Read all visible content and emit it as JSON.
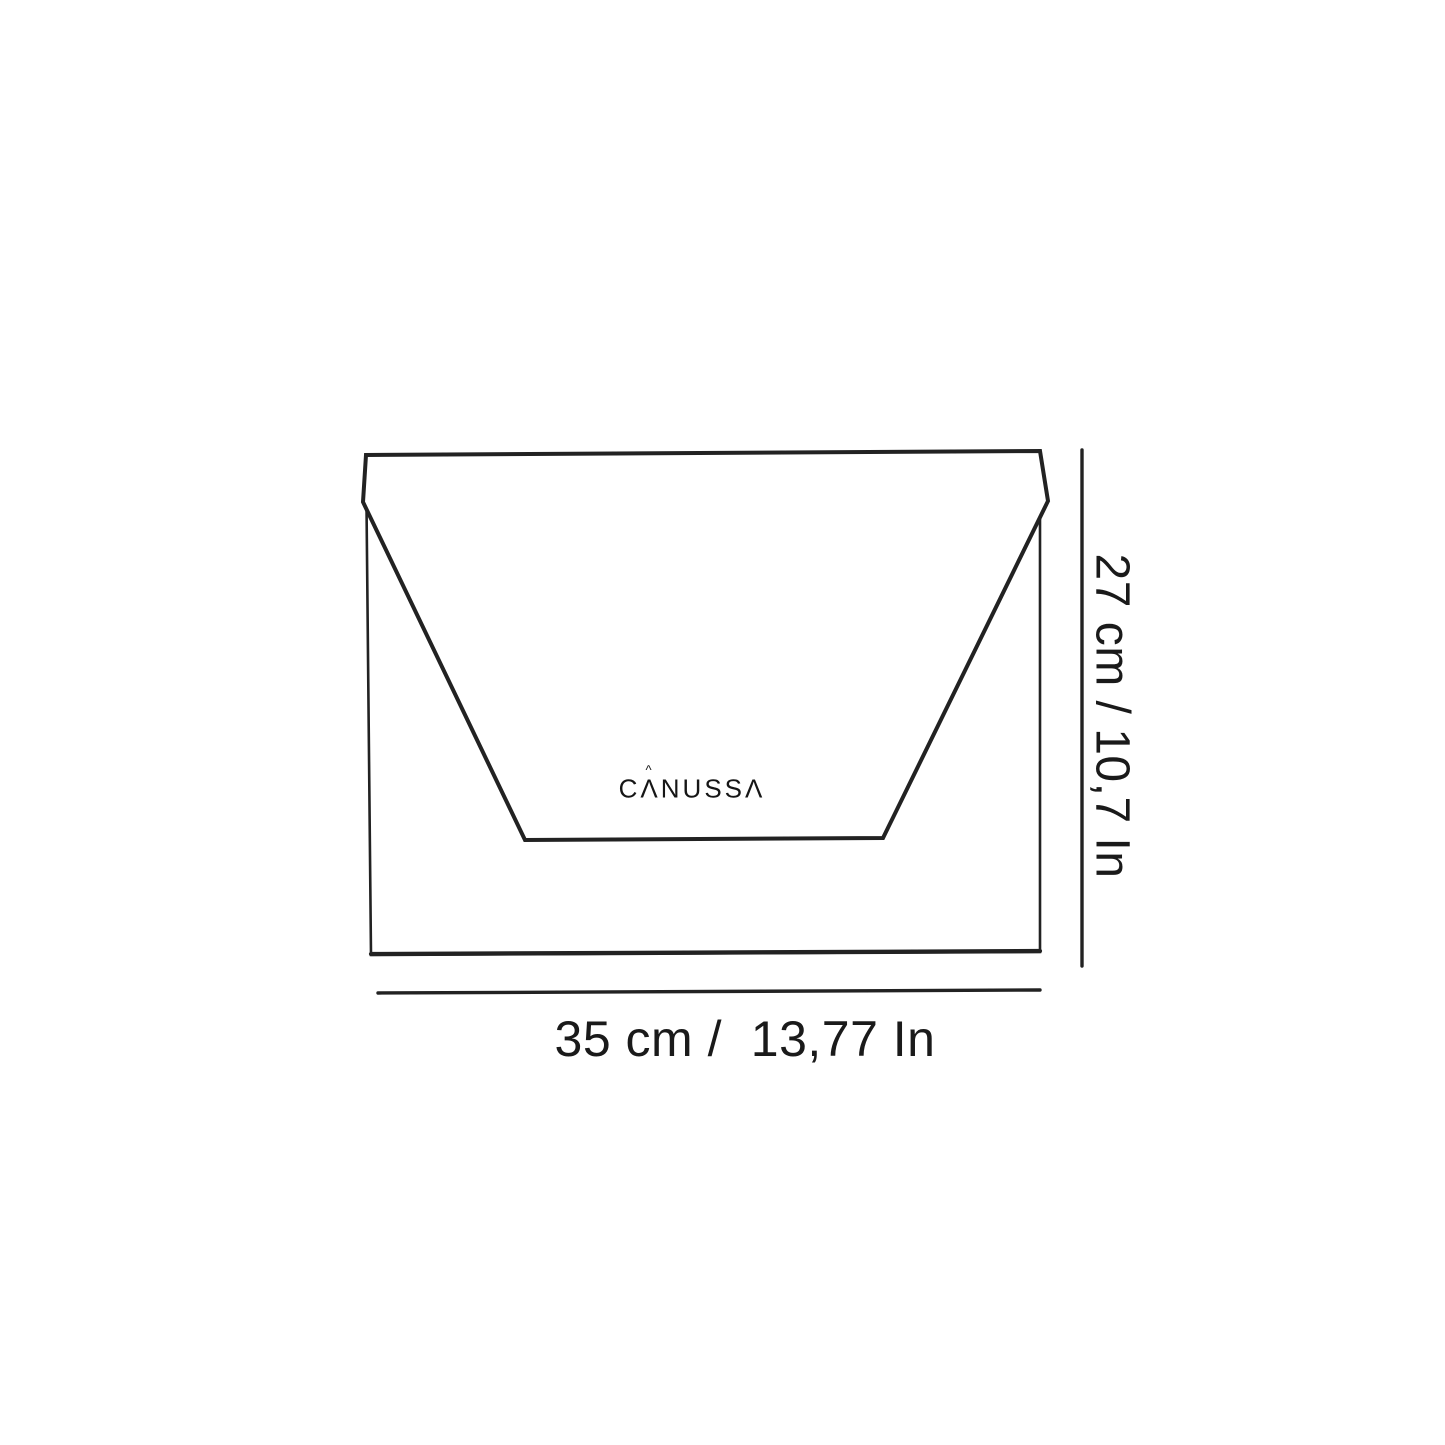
{
  "canvas": {
    "background": "#ffffff",
    "line_color": "#222222",
    "text_color": "#1a1a1a"
  },
  "drawing": {
    "brand_logo": {
      "full_text": "CANUSSA",
      "part1": "C",
      "part2": "Λ",
      "part3": "NUSS",
      "part4": "Λ",
      "accent": "^"
    }
  },
  "dimensions": {
    "height": {
      "label": "27 cm / 10,7 In",
      "value_cm": "27",
      "value_in": "10,7"
    },
    "width": {
      "label": "35 cm /  13,77 In",
      "value_cm": "35",
      "value_in": "13,77"
    }
  }
}
